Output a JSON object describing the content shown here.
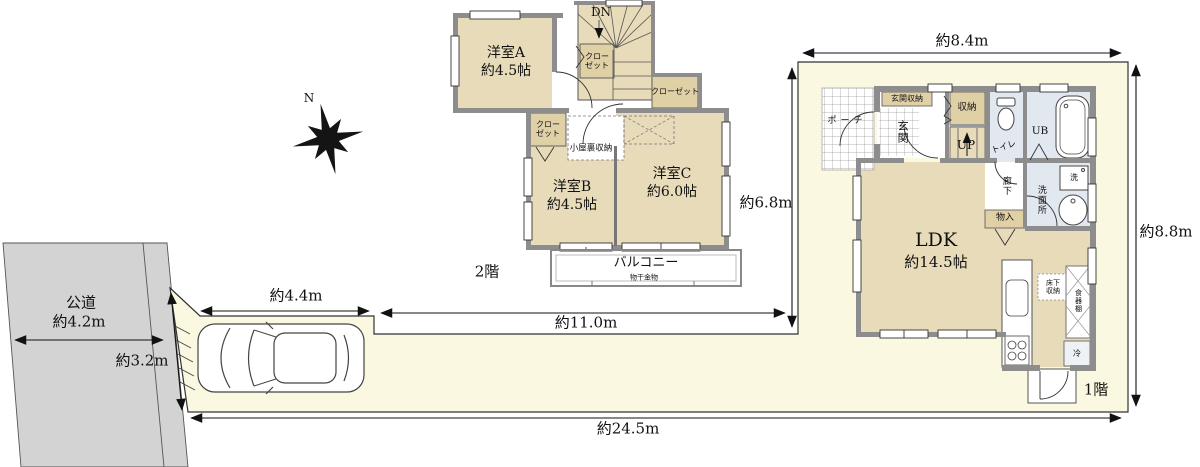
{
  "compass": {
    "north": "N"
  },
  "site": {
    "road_name": "公道",
    "road_width": "約4.2m",
    "frontage": "約3.2m",
    "width_top": "約8.4m",
    "depth_right": "約8.8m",
    "depth_inner": "約6.8m",
    "length_middle": "約11.0m",
    "parking_width": "約4.4m",
    "length_total": "約24.5m"
  },
  "floor2": {
    "label": "2階",
    "room_a_name": "洋室A",
    "room_a_size": "約4.5帖",
    "room_b_name": "洋室B",
    "room_b_size": "約4.5帖",
    "room_c_name": "洋室C",
    "room_c_size": "約6.0帖",
    "stairs_down": "DN",
    "closet": "クローゼット",
    "attic_storage": "小屋裏収納",
    "balcony": "バルコニー",
    "balcony_note": "物干金物"
  },
  "floor1": {
    "label": "1階",
    "ldk_name": "LDK",
    "ldk_size": "約14.5帖",
    "entrance": "玄関",
    "entrance_storage": "玄関収納",
    "storage": "収納",
    "stairs_up": "UP",
    "toilet": "トイレ",
    "bath": "UB",
    "washroom": "洗面所",
    "washer": "洗",
    "hallway": "廊下",
    "closet_small": "物入",
    "underfloor_storage": "床下収納",
    "cupboard": "食器棚",
    "fridge": "冷",
    "porch": "ポーチ"
  },
  "colors": {
    "site_fill": "#faf8e0",
    "road_fill": "#d3d3d3",
    "room_fill": "#e8dbba",
    "closet_fill": "#e0d0a6",
    "wet_room_fill": "#e2e8f0",
    "wall": "#8d8d8d",
    "line": "#111111"
  }
}
